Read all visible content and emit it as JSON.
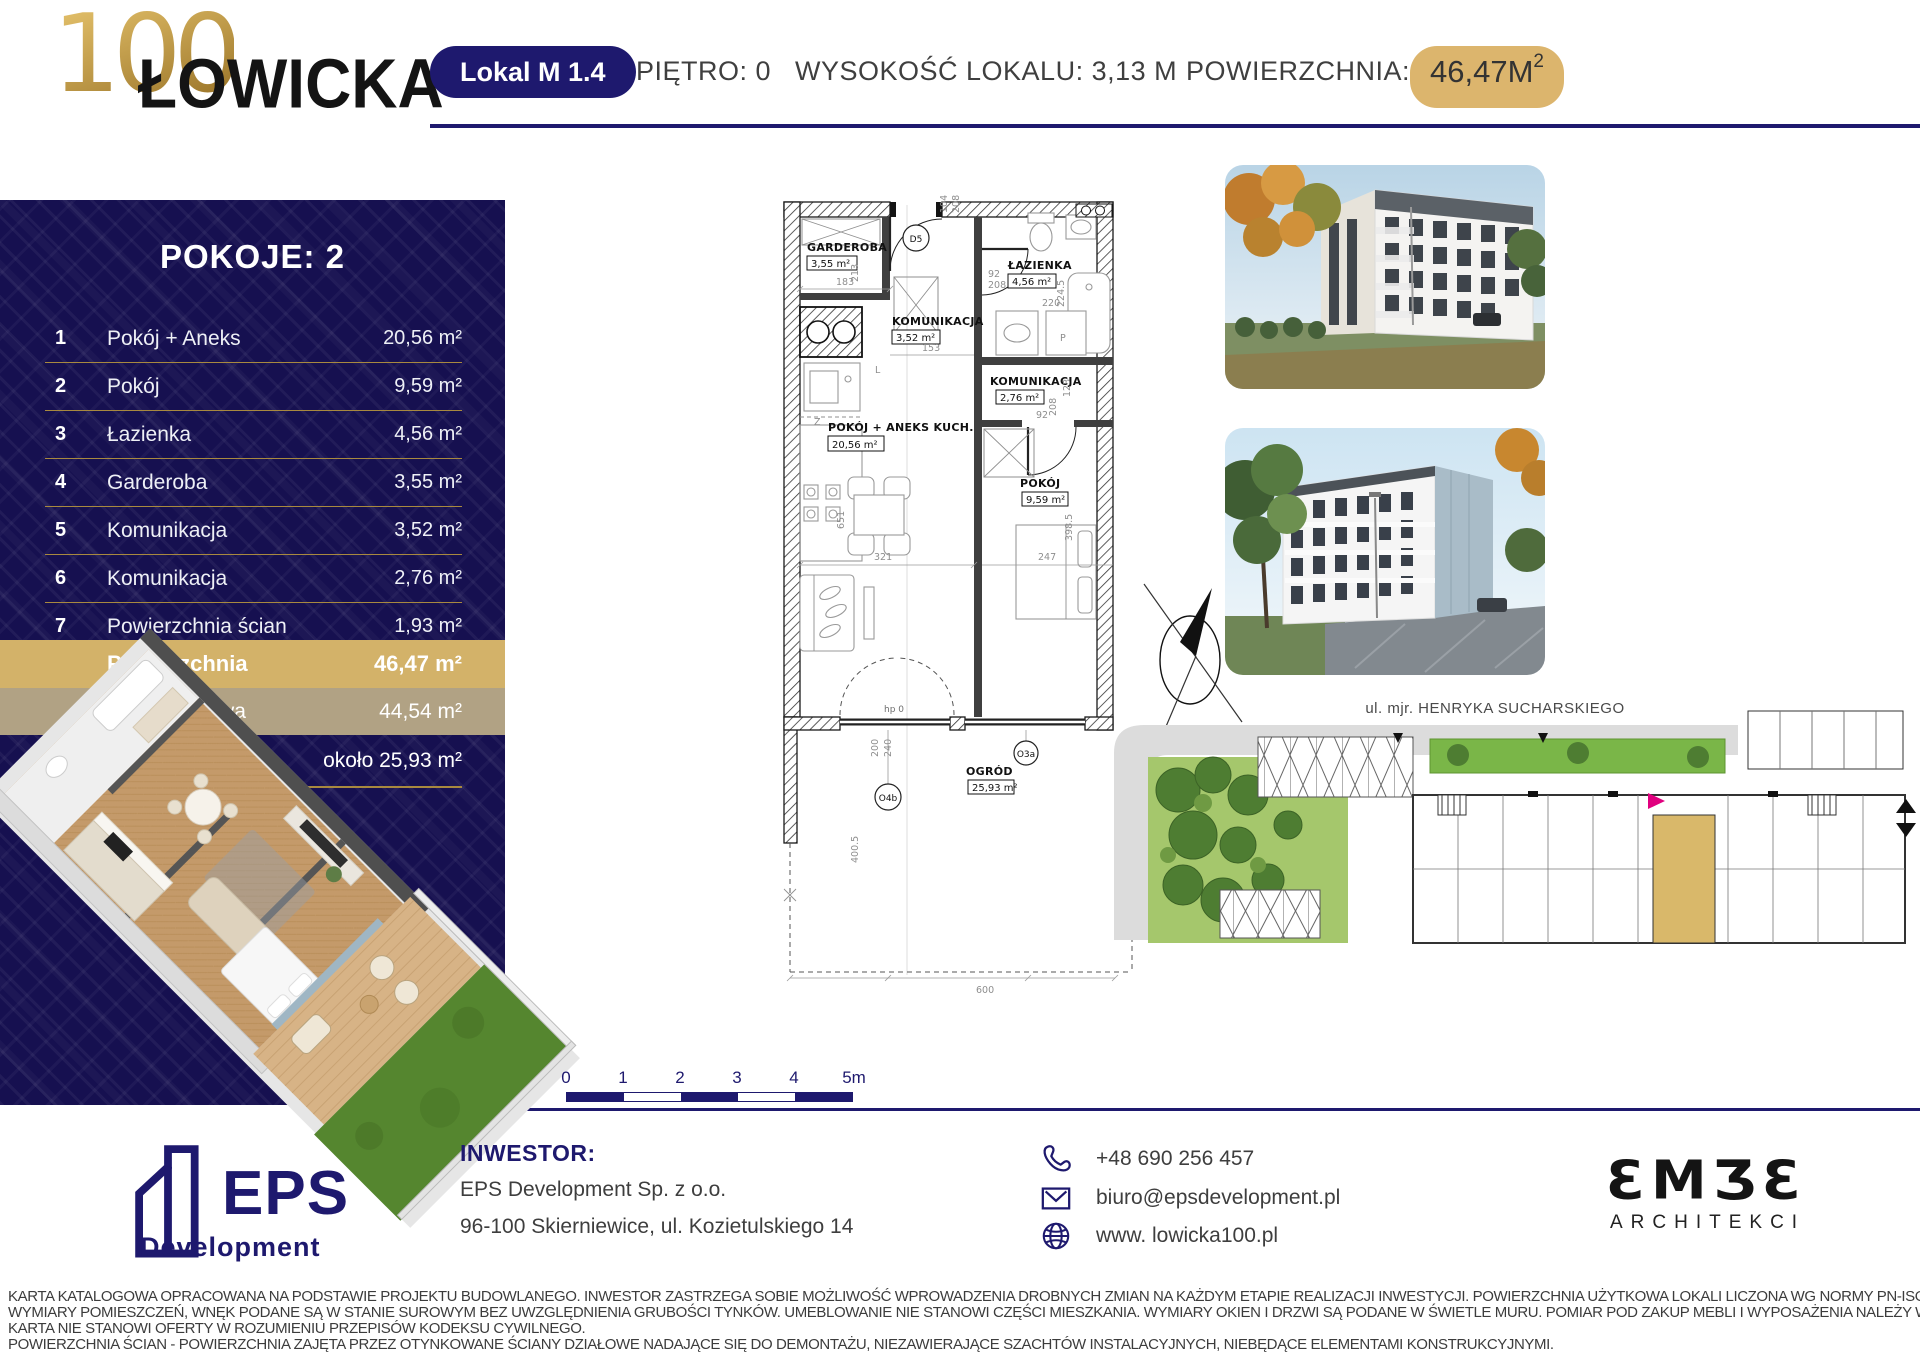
{
  "header": {
    "logo_number": "100",
    "logo_text": "ŁOWICKA",
    "unit_badge": "Lokal M 1.4",
    "floor": "PIĘTRO: 0",
    "height": "WYSOKOŚĆ LOKALU: 3,13 M",
    "area_label": "POWIERZCHNIA:",
    "area_value": "46,47M",
    "area_superscript": "2"
  },
  "sidebar": {
    "title": "POKOJE: 2",
    "rooms": [
      {
        "no": "1",
        "name": "Pokój + Aneks",
        "area": "20,56 m²"
      },
      {
        "no": "2",
        "name": "Pokój",
        "area": "9,59 m²"
      },
      {
        "no": "3",
        "name": "Łazienka",
        "area": "4,56 m²"
      },
      {
        "no": "4",
        "name": "Garderoba",
        "area": "3,55 m²"
      },
      {
        "no": "5",
        "name": "Komunikacja",
        "area": "3,52 m²"
      },
      {
        "no": "6",
        "name": "Komunikacja",
        "area": "2,76 m²"
      },
      {
        "no": "7",
        "name": "Powierzchnia ścian",
        "area": "1,93 m²"
      }
    ],
    "total": {
      "label": "Powierzchnia",
      "value": "46,47 m²"
    },
    "usable": {
      "label": "Pow. użytkowa",
      "value": "44,54 m²"
    },
    "garden": {
      "label": "Ogród",
      "value": "około 25,93 m²"
    }
  },
  "plan": {
    "rooms": {
      "garderoba": {
        "name": "GARDEROBA",
        "area": "3,55 m²"
      },
      "lazienka": {
        "name": "ŁAZIENKA",
        "area": "4,56 m²"
      },
      "komunikacja1": {
        "name": "KOMUNIKACJA",
        "area": "3,52 m²"
      },
      "komunikacja2": {
        "name": "KOMUNIKACJA",
        "area": "2,76 m²"
      },
      "pokoj_aneks": {
        "name": "POKÓJ + ANEKS KUCH.",
        "area": "20,56 m²"
      },
      "pokoj": {
        "name": "POKÓJ",
        "area": "9,59 m²"
      },
      "ogrod": {
        "name": "OGRÓD",
        "area": "25,93 m²"
      }
    },
    "markers": {
      "door": "D5",
      "window_garden": "O3a",
      "window_terrace": "O4b",
      "fridge": "L",
      "washer": "P",
      "sink": "Z",
      "hp": "hp 0"
    },
    "dims": {
      "w_garderoba": "183",
      "h_garderoba": "213",
      "w_hall": "153",
      "w_door": "92",
      "h_door": "208",
      "w_bath": "220",
      "h_bath": "224.5",
      "h_kom2": "123",
      "w_living": "321",
      "h_living": "651",
      "w_pokoj": "247",
      "h_pokoj": "398.5",
      "w_bed_door": "92",
      "h_bed_door": "208",
      "w_win": "200",
      "h_win": "240",
      "h_garden": "400.5",
      "w_garden": "600",
      "top1": "104",
      "top2": "208"
    }
  },
  "scalebar": {
    "labels": [
      "0",
      "1",
      "2",
      "3",
      "4",
      "5m"
    ]
  },
  "right": {
    "street_top": "ul. mjr. HENRYKA SUCHARSKIEGO",
    "street_left": "ul. Łowicka"
  },
  "footer": {
    "eps_name": "EPS",
    "eps_sub": "Development",
    "investor_heading": "INWESTOR:",
    "investor_name": "EPS Development Sp. z o.o.",
    "investor_address": "96-100 Skierniewice, ul. Kozietulskiego 14",
    "phone": "+48 690 256 457",
    "email": "biuro@epsdevelopment.pl",
    "website": "www. lowicka100.pl",
    "embe_name": "ƐMƷƐ",
    "embe_sub": "ARCHITEKCI"
  },
  "disclaimer": {
    "line1": "KARTA KATALOGOWA OPRACOWANA NA PODSTAWIE PROJEKTU BUDOWLANEGO. INWESTOR ZASTRZEGA SOBIE MOŻLIWOŚĆ WPROWADZENIA DROBNYCH ZMIAN NA KAŻDYM ETAPIE REALIZACJI INWESTYCJI. POWIERZCHNIA UŻYTKOWA LOKALI LICZONA WG NORMY PN-ISO 9836:2022-07.",
    "line2": "WYMIARY POMIESZCZEŃ, WNĘK PODANE SĄ W STANIE SUROWYM BEZ UWZGLĘDNIENIA GRUBOŚCI TYNKÓW. UMEBLOWANIE NIE STANOWI CZĘŚCI MIESZKANIA. WYMIARY OKIEN I DRZWI SĄ PODANE W ŚWIETLE MURU. POMIAR POD ZAKUP MEBLI I WYPOSAŻENIA NALEŻY WYKONAĆ Z NATURY.",
    "line3": "KARTA NIE STANOWI OFERTY W ROZUMIENIU PRZEPISÓW KODEKSU CYWILNEGO.",
    "line4": "POWIERZCHNIA ŚCIAN - POWIERZCHNIA ZAJĘTA PRZEZ OTYNKOWANE ŚCIANY DZIAŁOWE NADAJĄCE SIĘ DO DEMONTAŻU, NIEZAWIERAJĄCE SZACHTÓW INSTALACYJNYCH, NIEBĘDĄCE ELEMENTAMI KONSTRUKCYJNYMI."
  },
  "colors": {
    "navy": "#1e196e",
    "panel_navy": "#161050",
    "gold": "#d3b269",
    "gold_badge": "#dcb56d",
    "gold_line": "#a8893f",
    "tan": "#b1a284",
    "magenta_marker": "#e0007f"
  }
}
